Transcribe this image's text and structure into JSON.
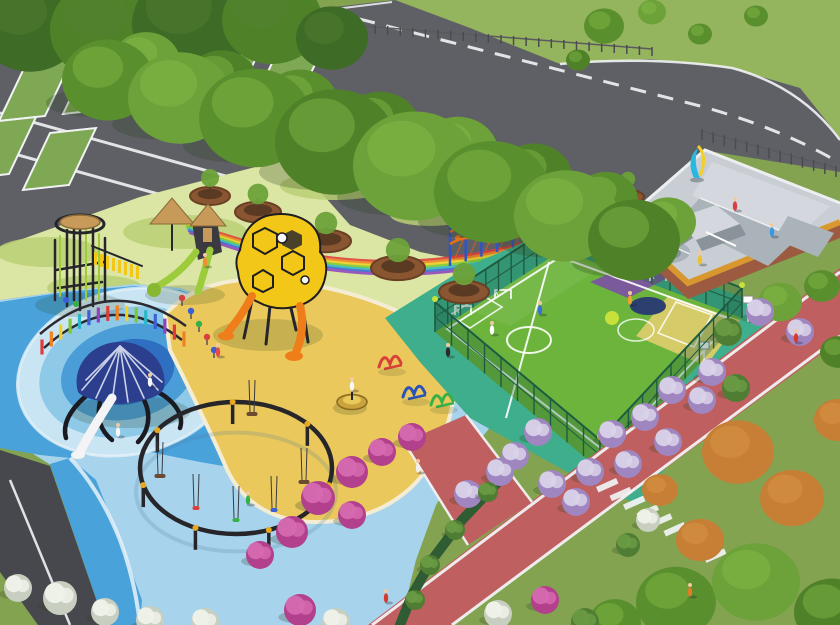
{
  "colors": {
    "lawn": "#83a351",
    "lawn2": "#8fae58",
    "grassTop": "#95b45e",
    "asphalt": "#5f6066",
    "asphaltDark": "#47484e",
    "line": "#f2f3f4",
    "stall": "#7fa855",
    "tree1": "#5a8f2e",
    "tree2": "#6da23a",
    "tree3": "#4f8228",
    "treeHL": "#8abf4a",
    "treeDark": "#3e6b26",
    "treeDarkHL": "#547f31",
    "orangeTree": "#c67f35",
    "orangeTreeHL": "#dc9a4e",
    "pale": "#dce6a4",
    "patch": "#b9cf74",
    "sand": "#eac85c",
    "sandEdge": "#f4edd3",
    "deck": "#a7d3ec",
    "waterMid": "#49a2da",
    "ring0": "#c9e4f2",
    "ring1": "#8fc9e8",
    "ring2": "#4a9dd6",
    "ring3": "#2e6fc2",
    "ring4": "#25418e",
    "seam": "#e6f2f8",
    "teal": "#3fae8c",
    "court": "#6cb43c",
    "purple": "#7b5a9b",
    "navy": "#2c4070",
    "cyellow": "#d5cb68",
    "courtSpot": "#c8e03a",
    "fence": "#1d5c40",
    "fenceFill": "rgba(26,92,64,0.30)",
    "skate": "#c9ced4",
    "skate2": "#d4d8de",
    "skateMid": "#aab2ba",
    "skateDark": "#8a929a",
    "border": "#d9982f",
    "brick": "#9c5a40",
    "wall": "#eceef0",
    "track": "#c05f5f",
    "hedge": "#2f5c33",
    "planter": "#8a5632",
    "planterIn": "#5a3a22",
    "black": "#26262a",
    "wood": "#c89a5a",
    "lime": "#9ccb3b",
    "limeDark": "#86b832",
    "orange": "#ef7d1a",
    "hex": "#f2c718",
    "dome": "#2b3f8e",
    "slideWhite": "#f4f4f6",
    "rope": "#e8701a",
    "ropeNet": "#d86018",
    "ropePost": "#2f55c4",
    "ropePost2": "#7040c0",
    "cyan": "#2ab8e0",
    "sun": "#f2d026",
    "clamp": "#e8a820",
    "shadow": "#2e401e",
    "skin": "#f2c9a0"
  },
  "scene": {
    "rainbowColors": [
      "#e03a3a",
      "#f08020",
      "#f2d024",
      "#7cc832",
      "#2ab8c8",
      "#3a5fd8",
      "#9040c0"
    ],
    "treesBack": [
      {
        "x": 146,
        "y": 62,
        "r": 34,
        "c": "tree2"
      },
      {
        "x": 222,
        "y": 82,
        "r": 36,
        "c": "tree3"
      },
      {
        "x": 300,
        "y": 103,
        "r": 38,
        "c": "tree1"
      },
      {
        "x": 380,
        "y": 127,
        "r": 40,
        "c": "tree3"
      },
      {
        "x": 458,
        "y": 152,
        "r": 40,
        "c": "tree2"
      },
      {
        "x": 534,
        "y": 177,
        "r": 38,
        "c": "tree3"
      },
      {
        "x": 606,
        "y": 200,
        "r": 32,
        "c": "tree1"
      },
      {
        "x": 668,
        "y": 222,
        "r": 28,
        "c": "tree2"
      }
    ],
    "treesRow": [
      {
        "x": 108,
        "y": 80,
        "r": 46,
        "c": "tree1"
      },
      {
        "x": 180,
        "y": 98,
        "r": 52,
        "c": "tree2"
      },
      {
        "x": 255,
        "y": 118,
        "r": 56,
        "c": "tree1"
      },
      {
        "x": 335,
        "y": 142,
        "r": 60,
        "c": "tree3"
      },
      {
        "x": 415,
        "y": 166,
        "r": 62,
        "c": "tree2"
      },
      {
        "x": 492,
        "y": 192,
        "r": 58,
        "c": "tree1"
      },
      {
        "x": 566,
        "y": 216,
        "r": 52,
        "c": "tree2"
      },
      {
        "x": 634,
        "y": 240,
        "r": 46,
        "c": "tree3"
      }
    ],
    "treesTopLeft": [
      {
        "x": 30,
        "y": 26,
        "r": 52,
        "c": "treeDark"
      },
      {
        "x": 108,
        "y": 30,
        "r": 58,
        "c": "tree3"
      },
      {
        "x": 192,
        "y": 24,
        "r": 60,
        "c": "treeDark"
      },
      {
        "x": 272,
        "y": 20,
        "r": 50,
        "c": "tree3"
      },
      {
        "x": 332,
        "y": 38,
        "r": 36,
        "c": "treeDark"
      }
    ],
    "treesGrass": [
      {
        "x": 604,
        "y": 26,
        "r": 20,
        "c": "tree1"
      },
      {
        "x": 652,
        "y": 12,
        "r": 14,
        "c": "tree2"
      },
      {
        "x": 700,
        "y": 34,
        "r": 12,
        "c": "tree1"
      },
      {
        "x": 578,
        "y": 60,
        "r": 12,
        "c": "tree3"
      },
      {
        "x": 756,
        "y": 16,
        "r": 12,
        "c": "tree1"
      }
    ],
    "treesOrange": [
      {
        "x": 738,
        "y": 452,
        "r": 36,
        "c": "orangeTree"
      },
      {
        "x": 792,
        "y": 498,
        "r": 32,
        "c": "orangeTree"
      },
      {
        "x": 838,
        "y": 420,
        "r": 24,
        "c": "orangeTree"
      },
      {
        "x": 700,
        "y": 540,
        "r": 24,
        "c": "orangeTree"
      },
      {
        "x": 660,
        "y": 490,
        "r": 18,
        "c": "orangeTree"
      }
    ],
    "treesBR": [
      {
        "x": 676,
        "y": 602,
        "r": 40,
        "c": "tree1"
      },
      {
        "x": 756,
        "y": 582,
        "r": 44,
        "c": "tree2"
      },
      {
        "x": 832,
        "y": 612,
        "r": 38,
        "c": "tree3"
      },
      {
        "x": 615,
        "y": 622,
        "r": 26,
        "c": "tree1"
      },
      {
        "x": 780,
        "y": 302,
        "r": 22,
        "c": "tree2"
      },
      {
        "x": 822,
        "y": 286,
        "r": 18,
        "c": "tree1"
      },
      {
        "x": 838,
        "y": 352,
        "r": 18,
        "c": "tree3"
      }
    ],
    "planters": [
      {
        "x": 210,
        "y": 196,
        "r": 20,
        "t": 1
      },
      {
        "x": 258,
        "y": 212,
        "r": 23,
        "t": 1
      },
      {
        "x": 326,
        "y": 241,
        "r": 25,
        "t": 1
      },
      {
        "x": 398,
        "y": 268,
        "r": 27,
        "t": 1
      },
      {
        "x": 464,
        "y": 292,
        "r": 25,
        "t": 1
      },
      {
        "x": 551,
        "y": 233,
        "r": 18,
        "t": 1
      },
      {
        "x": 585,
        "y": 212,
        "r": 16,
        "t": 0
      },
      {
        "x": 628,
        "y": 197,
        "r": 16,
        "t": 1
      }
    ],
    "bushTypes": {
      "m": [
        "#b2408c",
        "#d66ab0"
      ],
      "p": [
        "#9f86c0",
        "#d9d2e8"
      ],
      "w": [
        "#c8cfc0",
        "#f0f2ea"
      ],
      "g": [
        "#4f7d33",
        "#6a9a44"
      ]
    },
    "bushes": [
      {
        "x": 672,
        "y": 390,
        "t": "p"
      },
      {
        "x": 702,
        "y": 400,
        "t": "p"
      },
      {
        "x": 645,
        "y": 417,
        "t": "p"
      },
      {
        "x": 612,
        "y": 434,
        "t": "p"
      },
      {
        "x": 668,
        "y": 442,
        "t": "p"
      },
      {
        "x": 628,
        "y": 464,
        "t": "p"
      },
      {
        "x": 590,
        "y": 472,
        "t": "p"
      },
      {
        "x": 552,
        "y": 484,
        "t": "p"
      },
      {
        "x": 576,
        "y": 502,
        "t": "p"
      },
      {
        "x": 538,
        "y": 432,
        "t": "p"
      },
      {
        "x": 515,
        "y": 456,
        "t": "p"
      },
      {
        "x": 500,
        "y": 472,
        "t": "p"
      },
      {
        "x": 468,
        "y": 494,
        "t": "p"
      },
      {
        "x": 760,
        "y": 312,
        "t": "p"
      },
      {
        "x": 800,
        "y": 332,
        "t": "p"
      },
      {
        "x": 728,
        "y": 332,
        "t": "g"
      },
      {
        "x": 712,
        "y": 372,
        "t": "p"
      },
      {
        "x": 736,
        "y": 388,
        "t": "g"
      },
      {
        "x": 352,
        "y": 472,
        "t": "m",
        "r": 16
      },
      {
        "x": 382,
        "y": 452,
        "t": "m"
      },
      {
        "x": 318,
        "y": 498,
        "t": "m",
        "r": 17
      },
      {
        "x": 352,
        "y": 515,
        "t": "m"
      },
      {
        "x": 292,
        "y": 532,
        "t": "m",
        "r": 16
      },
      {
        "x": 260,
        "y": 555,
        "t": "m"
      },
      {
        "x": 412,
        "y": 437,
        "t": "m"
      },
      {
        "x": 300,
        "y": 610,
        "t": "m",
        "r": 16
      },
      {
        "x": 336,
        "y": 622,
        "t": "w"
      },
      {
        "x": 60,
        "y": 598,
        "t": "w",
        "r": 17
      },
      {
        "x": 105,
        "y": 612,
        "t": "w"
      },
      {
        "x": 18,
        "y": 588,
        "t": "w"
      },
      {
        "x": 150,
        "y": 620,
        "t": "w"
      },
      {
        "x": 205,
        "y": 622,
        "t": "w"
      },
      {
        "x": 498,
        "y": 614,
        "t": "w"
      },
      {
        "x": 545,
        "y": 600,
        "t": "m"
      },
      {
        "x": 585,
        "y": 622,
        "t": "g"
      },
      {
        "x": 648,
        "y": 520,
        "t": "w",
        "r": 12
      },
      {
        "x": 628,
        "y": 545,
        "t": "g",
        "r": 12
      },
      {
        "x": 488,
        "y": 492,
        "t": "g",
        "r": 10
      },
      {
        "x": 455,
        "y": 530,
        "t": "g",
        "r": 10
      },
      {
        "x": 430,
        "y": 565,
        "t": "g",
        "r": 10
      },
      {
        "x": 415,
        "y": 600,
        "t": "g",
        "r": 10
      }
    ],
    "people": [
      {
        "x": 796,
        "y": 338,
        "c": "#d63a2f"
      },
      {
        "x": 690,
        "y": 592,
        "c": "#e07b28"
      },
      {
        "x": 386,
        "y": 598,
        "c": "#d63a2f"
      },
      {
        "x": 418,
        "y": 468,
        "c": "#f0f0f0"
      },
      {
        "x": 352,
        "y": 386,
        "c": "#f8f8f8"
      },
      {
        "x": 492,
        "y": 330,
        "c": "#ffffff"
      },
      {
        "x": 540,
        "y": 310,
        "c": "#3a6fd8"
      },
      {
        "x": 630,
        "y": 300,
        "c": "#f0a030"
      },
      {
        "x": 735,
        "y": 206,
        "c": "#d84040"
      },
      {
        "x": 700,
        "y": 260,
        "c": "#f0c030"
      },
      {
        "x": 772,
        "y": 232,
        "c": "#3898e0"
      },
      {
        "x": 218,
        "y": 352,
        "c": "#e84848"
      },
      {
        "x": 150,
        "y": 382,
        "c": "#f8f8f8"
      },
      {
        "x": 205,
        "y": 262,
        "c": "#f09030"
      },
      {
        "x": 448,
        "y": 352,
        "c": "#2a2a2a"
      },
      {
        "x": 118,
        "y": 432,
        "c": "#f8f8f8"
      },
      {
        "x": 248,
        "y": 500,
        "c": "#38b048"
      }
    ],
    "stallsRow1": [
      {
        "x": 26,
        "y": 64
      },
      {
        "x": 90,
        "y": 57
      },
      {
        "x": 154,
        "y": 51
      },
      {
        "x": 218,
        "y": 46
      },
      {
        "x": 282,
        "y": 42
      }
    ],
    "stallsRow2": [
      {
        "x": -10,
        "y": 122
      },
      {
        "x": 50,
        "y": 133
      }
    ],
    "roadFences": [
      {
        "x1": 287,
        "y1": 27,
        "x2": 652,
        "y2": 56,
        "n": 30,
        "h": 9
      },
      {
        "x1": 702,
        "y1": 140,
        "x2": 836,
        "y2": 177,
        "n": 13,
        "h": 11
      }
    ],
    "waterRings": {
      "cx": 128,
      "cy": 372,
      "rot": -14,
      "list": [
        [
          112,
          82,
          "ring0"
        ],
        [
          90,
          64,
          "ring1"
        ],
        [
          68,
          47,
          "ring2"
        ],
        [
          47,
          32,
          "ring3"
        ],
        [
          28,
          19,
          "ring4"
        ]
      ]
    },
    "arch": {
      "p0": [
        42,
        340
      ],
      "pc": [
        112,
        276
      ],
      "p1": [
        184,
        332
      ],
      "n": 16,
      "len": 15
    },
    "courtFence": {
      "h": 30,
      "edges": [
        [
          435,
          332,
          562,
          250
        ],
        [
          562,
          250,
          742,
          318
        ],
        [
          435,
          332,
          600,
          470
        ],
        [
          600,
          470,
          742,
          318
        ]
      ]
    },
    "goals": [
      {
        "x": 463,
        "y": 315
      },
      {
        "x": 503,
        "y": 299
      },
      {
        "x": 622,
        "y": 263
      },
      {
        "x": 658,
        "y": 281
      }
    ],
    "hoops": [
      {
        "x": 704,
        "y": 368
      },
      {
        "x": 748,
        "y": 322
      }
    ],
    "rope": {
      "x": 450,
      "y": 266,
      "n": 7,
      "dx": 15.7,
      "dy": -4.67,
      "h": 46
    },
    "swing": {
      "cx": 236,
      "cy": 468,
      "rx": 96,
      "ry": 66,
      "postAngles": [
        165,
        215,
        268,
        318,
        15,
        70,
        115
      ],
      "seats": [
        {
          "x": 196,
          "y": 506,
          "c": "#d8403a",
          "w": 7
        },
        {
          "x": 236,
          "y": 518,
          "c": "#38b048",
          "w": 7
        },
        {
          "x": 274,
          "y": 508,
          "c": "#3a5fd8",
          "w": 7
        },
        {
          "x": 160,
          "y": 474,
          "c": "#6b4a32",
          "w": 11
        },
        {
          "x": 304,
          "y": 480,
          "c": "#6b4a32",
          "w": 11
        },
        {
          "x": 252,
          "y": 412,
          "c": "#6b4a32",
          "w": 11
        }
      ]
    },
    "fitness": [
      {
        "x": 390,
        "y": 362,
        "c": "#d8403a"
      },
      {
        "x": 414,
        "y": 392,
        "c": "#2a52b8"
      },
      {
        "x": 442,
        "y": 400,
        "c": "#38b048"
      }
    ],
    "springs": [
      {
        "x": 182,
        "y": 306,
        "c": "#d84040"
      },
      {
        "x": 191,
        "y": 319,
        "c": "#3a5fd8"
      },
      {
        "x": 199,
        "y": 332,
        "c": "#38b048"
      },
      {
        "x": 207,
        "y": 345,
        "c": "#d84040"
      },
      {
        "x": 214,
        "y": 358,
        "c": "#3a5fd8"
      }
    ],
    "crosswalk": {
      "x": 596,
      "y": 487,
      "dx": 13.5,
      "dy": 8.8,
      "n": 9,
      "w": 22,
      "h": 6,
      "rot": -24
    },
    "patches": [
      {
        "x": 48,
        "y": 252,
        "rx": 52,
        "ry": 15
      },
      {
        "x": 185,
        "y": 232,
        "rx": 62,
        "ry": 17
      },
      {
        "x": 335,
        "y": 186,
        "rx": 55,
        "ry": 14
      },
      {
        "x": 95,
        "y": 288,
        "rx": 48,
        "ry": 13
      },
      {
        "x": 430,
        "y": 215,
        "rx": 40,
        "ry": 11
      }
    ]
  }
}
